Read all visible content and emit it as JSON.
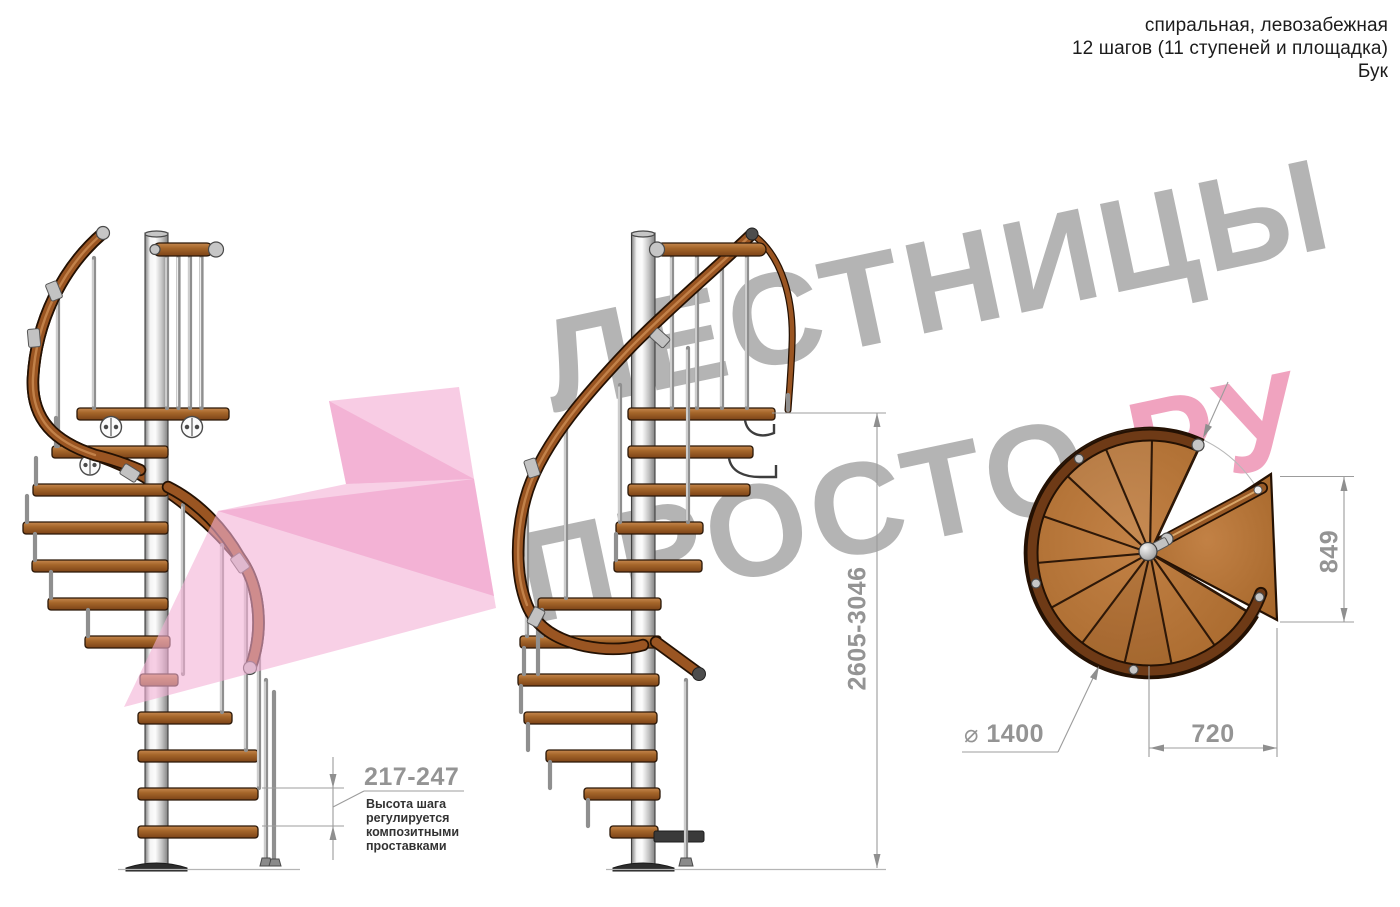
{
  "header": {
    "type_line": "спиральная, левозабежная",
    "steps_line": "12 шагов (11 ступеней и площадка)",
    "material_line": "Бук"
  },
  "watermark": {
    "word_top": "ЛЕСТНИЦЫ",
    "word_bottom_gray": "ПРОСТО",
    "word_bottom_dot": ".",
    "word_bottom_pink": "РУ",
    "gray_color": "#b4b4b4",
    "pink_color": "#f0a3bf",
    "dot_color": "#dd5377",
    "arrow_color": "#f4b0d5"
  },
  "dimensions": {
    "step_height": {
      "value": "217-247",
      "note": "Высота шага регулируется композитными проставками"
    },
    "total_height": {
      "value": "2605-3046"
    },
    "plan_depth": {
      "value": "849"
    },
    "plan_width": {
      "value": "720"
    },
    "diameter": {
      "symbol": "⌀",
      "value": "1400"
    }
  },
  "colors": {
    "wood": "#a5662a",
    "handrail_wood": "#9a5522",
    "plan_wood": "#b0702e",
    "metal": "#c9c9c9",
    "dimension_gray": "#949494",
    "note_text": "#333333",
    "header_text": "#1c1c1c"
  }
}
